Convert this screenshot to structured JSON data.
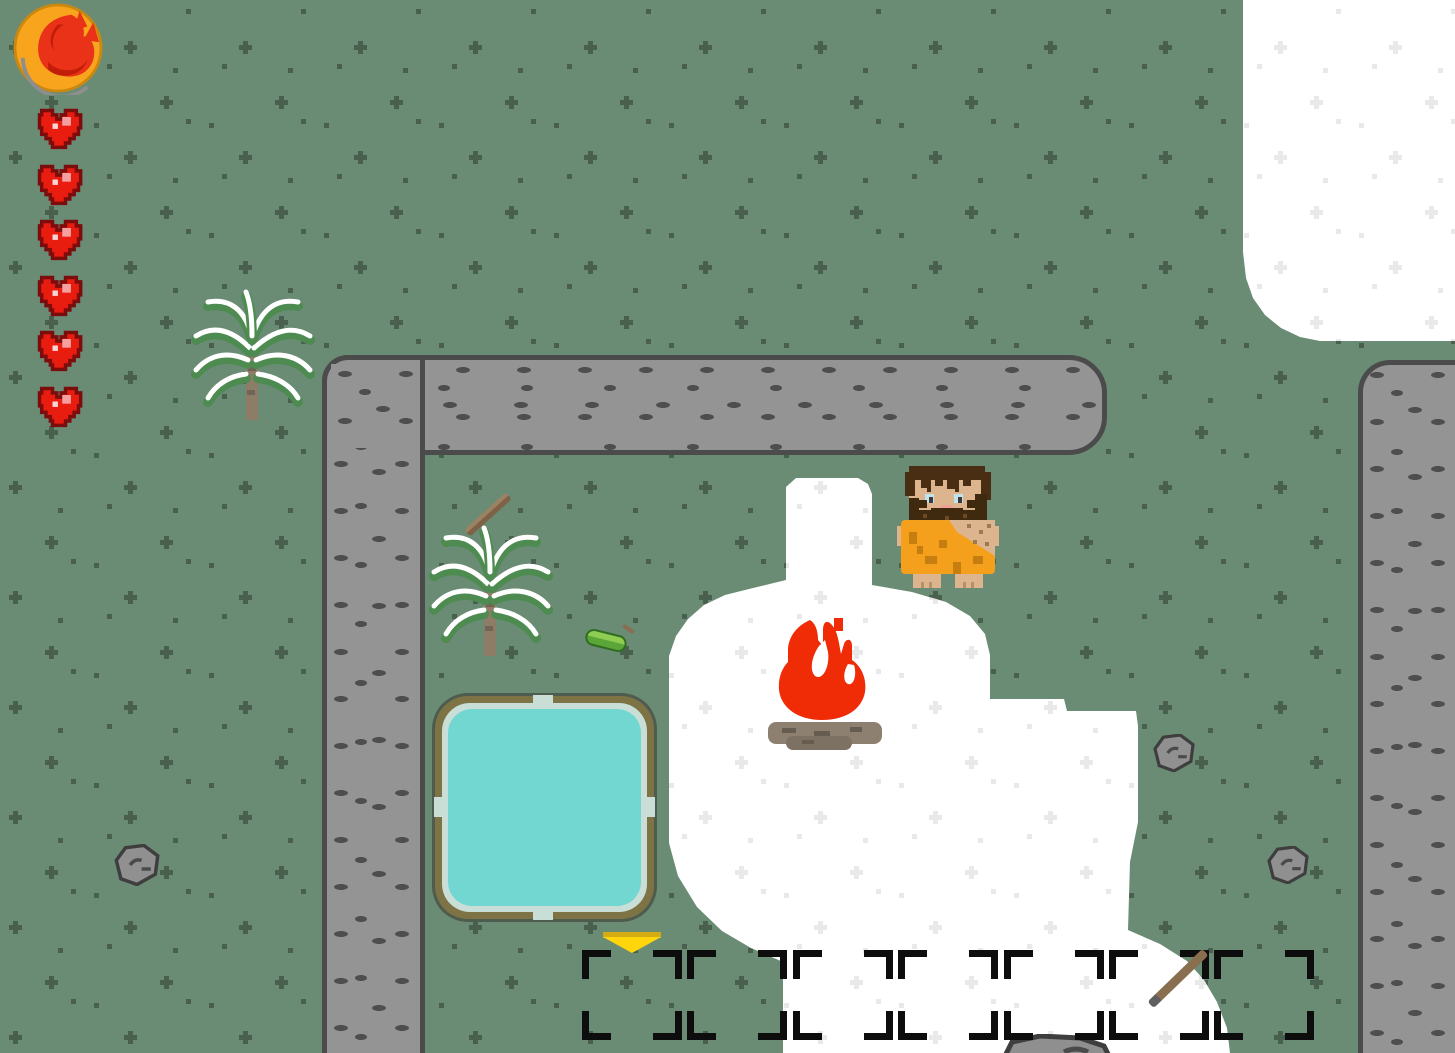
{
  "game": {
    "genre": "top-down pixel survival",
    "scene": "snowy grassland camp enclosed by stone walls"
  },
  "hud": {
    "ability_icon": {
      "name": "fire-ability",
      "glyph": "flame",
      "circle_color": "#f8a51d",
      "flame_color": "#e93217"
    },
    "health": {
      "unit": "heart",
      "current": 6,
      "max": 6,
      "heart_color": "#e91c10",
      "outline_color": "#7c0d0d"
    }
  },
  "hotbar": {
    "slot_count": 7,
    "selected_slot": 1,
    "selection_indicator_color": "#ffd60b",
    "bracket_color": "#0d0d0d",
    "items": [
      {
        "slot": 6,
        "name": "stone-tipped spear",
        "shaft_color": "#8a6e50",
        "tip_color": "#5f5f5f"
      }
    ]
  },
  "world": {
    "ground_color": "#6a8c75",
    "ground_pattern_color": "#49604f",
    "snow_color": "#ffffff",
    "snow_pattern_color": "#e9e9e9",
    "player": {
      "name": "caveman",
      "hair": "dark brown",
      "outfit": "orange hide toga",
      "x": 893,
      "y": 464
    },
    "campfire": {
      "state": "lit",
      "flame_color": "#ef2c06",
      "log_color": "#8d8070",
      "x": 762,
      "y": 610
    },
    "pond": {
      "water_color": "#73d7d1",
      "rim_color": "#7d7345",
      "x": 432,
      "y": 693,
      "width": 225,
      "height": 229
    },
    "ferns": [
      {
        "x": 190,
        "y": 288
      },
      {
        "x": 428,
        "y": 524
      }
    ],
    "rocks": [
      {
        "x": 114,
        "y": 844,
        "w": 46,
        "h": 42
      },
      {
        "x": 1152,
        "y": 734,
        "w": 44,
        "h": 38
      },
      {
        "x": 1266,
        "y": 846,
        "w": 44,
        "h": 38
      }
    ],
    "big_rock": {
      "x": 1000,
      "y": 1034,
      "w": 116,
      "h": 46
    },
    "ground_items": [
      {
        "name": "wooden stick",
        "x": 460,
        "y": 508
      },
      {
        "name": "seed pod",
        "x": 585,
        "y": 630
      }
    ],
    "snow_patches": [
      "top-right corner",
      "around campfire extending to bottom"
    ],
    "walls": [
      {
        "segment": "top horizontal bar"
      },
      {
        "segment": "left vertical column"
      },
      {
        "segment": "right vertical column"
      }
    ]
  }
}
